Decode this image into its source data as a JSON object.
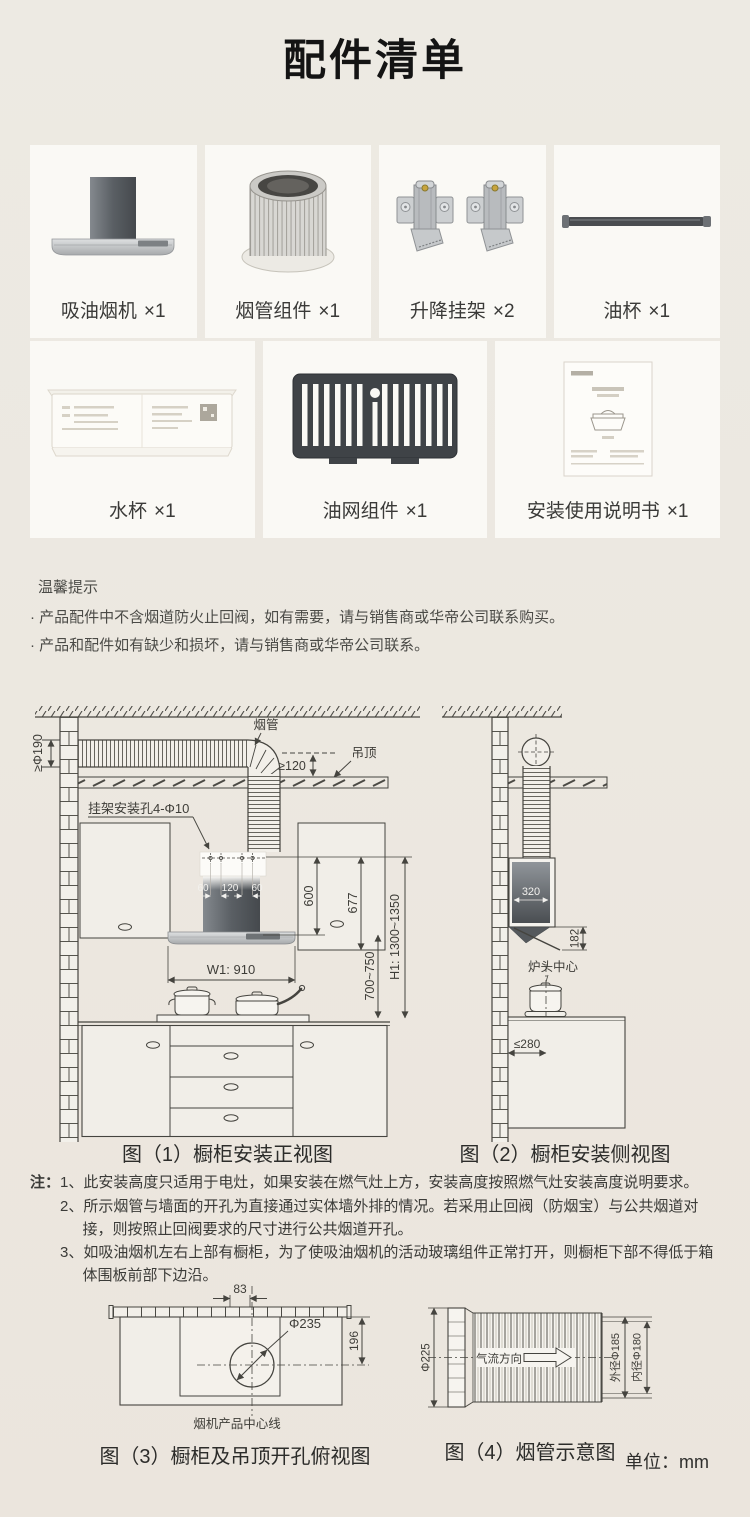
{
  "page": {
    "title": "配件清单",
    "unit_label": "单位：mm"
  },
  "accessories": [
    {
      "label": "吸油烟机",
      "qty": "×1",
      "icon": "range-hood"
    },
    {
      "label": "烟管组件",
      "qty": "×1",
      "icon": "exhaust-duct"
    },
    {
      "label": "升降挂架",
      "qty": "×2",
      "icon": "lift-brackets"
    },
    {
      "label": "油杯",
      "qty": "×1",
      "icon": "oil-cup"
    },
    {
      "label": "水杯",
      "qty": "×1",
      "icon": "water-tray"
    },
    {
      "label": "油网组件",
      "qty": "×1",
      "icon": "grease-filter"
    },
    {
      "label": "安装使用说明书",
      "qty": "×1",
      "icon": "instruction-manual"
    }
  ],
  "tips": {
    "title": "温馨提示",
    "items": [
      "· 产品配件中不含烟道防火止回阀，如有需要，请与销售商或华帝公司联系购买。",
      "· 产品和配件如有缺少和损坏，请与销售商或华帝公司联系。"
    ]
  },
  "notes": {
    "prefix": "注：",
    "items": [
      "1、此安装高度只适用于电灶，如果安装在燃气灶上方，安装高度按照燃气灶安装高度说明要求。",
      "2、所示烟管与墙面的开孔为直接通过实体墙外排的情况。若采用止回阀（防烟宝）与公共烟道对接，则按照止回阀要求的尺寸进行公共烟道开孔。",
      "3、如吸油烟机左右上部有橱柜，为了使吸油烟机的活动玻璃组件正常打开，则橱柜下部不得低于箱体围板前部下边沿。"
    ]
  },
  "figure1": {
    "caption": "图（1）橱柜安装正视图",
    "labels": {
      "duct": "烟管",
      "ceiling": "吊顶",
      "duct_clearance": "≥120",
      "duct_diameter": "≥Φ190",
      "bracket_holes": "挂架安装孔4-Φ10",
      "hole_span_left": "60",
      "hole_span_mid": "120",
      "hole_span_right": "60",
      "dim_600": "600",
      "dim_677": "677",
      "dim_h1": "H1: 1300~1350",
      "dim_height_range": "700~750",
      "dim_w1": "W1: 910"
    }
  },
  "figure2": {
    "caption": "图（2）橱柜安装侧视图",
    "labels": {
      "dim_depth": "320",
      "dim_glass": "182",
      "burner_center": "炉头中心",
      "dim_wall_distance": "≤280"
    }
  },
  "figure3": {
    "caption": "图（3）橱柜及吊顶开孔俯视图",
    "labels": {
      "dim_83": "83",
      "hole_diameter": "Φ235",
      "dim_196": "196",
      "center_line": "烟机产品中心线"
    }
  },
  "figure4": {
    "caption": "图（4）烟管示意图",
    "labels": {
      "dim_dia_225": "Φ225",
      "airflow": "气流方向",
      "outer_dia": "外径Φ185",
      "inner_dia": "内径Φ180"
    }
  }
}
